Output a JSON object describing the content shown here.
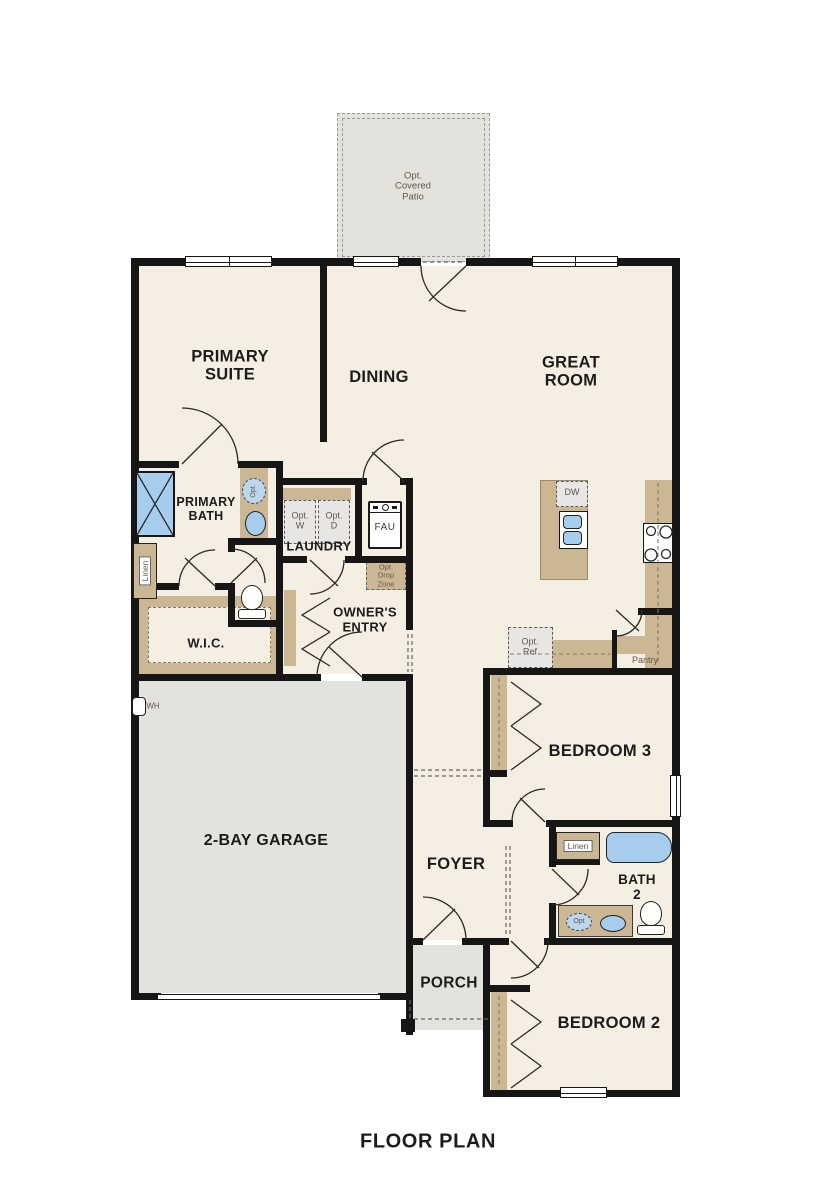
{
  "title": "FLOOR PLAN",
  "colors": {
    "floor": "#f5efe3",
    "outdoor": "#e4e2dd",
    "cabinet": "#ccb795",
    "fixture_blue": "#a7cdee",
    "wall": "#161616",
    "optional_fill": "#e7e6e4",
    "label": "#1c1c1c",
    "small_label": "#5f574c"
  },
  "rooms": {
    "opt_covered_patio": {
      "label": "Opt.\nCovered\nPatio"
    },
    "primary_suite": {
      "label": "PRIMARY\nSUITE"
    },
    "dining": {
      "label": "DINING"
    },
    "great_room": {
      "label": "GREAT\nROOM"
    },
    "primary_bath": {
      "label": "PRIMARY\nBATH"
    },
    "wic": {
      "label": "W.I.C."
    },
    "laundry": {
      "label": "LAUNDRY"
    },
    "owners_entry": {
      "label": "OWNER'S\nENTRY"
    },
    "garage": {
      "label": "2-BAY GARAGE"
    },
    "bedroom3": {
      "label": "BEDROOM 3"
    },
    "foyer": {
      "label": "FOYER"
    },
    "bath2": {
      "label": "BATH\n2"
    },
    "porch": {
      "label": "PORCH"
    },
    "bedroom2": {
      "label": "BEDROOM 2"
    }
  },
  "fixtures": {
    "opt_washer": "Opt.\nW",
    "opt_dryer": "Opt.\nD",
    "fau": "FAU",
    "opt_drop_zone": "Opt.\nDrop\nZone",
    "dishwasher": "DW",
    "opt_refrigerator": "Opt.\nRef",
    "pantry": "Pantry",
    "linen_primary": "Linen",
    "linen_bath2": "Linen",
    "water_heater": "WH",
    "opt_sink_primary": "Opt.",
    "opt_sink_bath2": "Opt"
  }
}
